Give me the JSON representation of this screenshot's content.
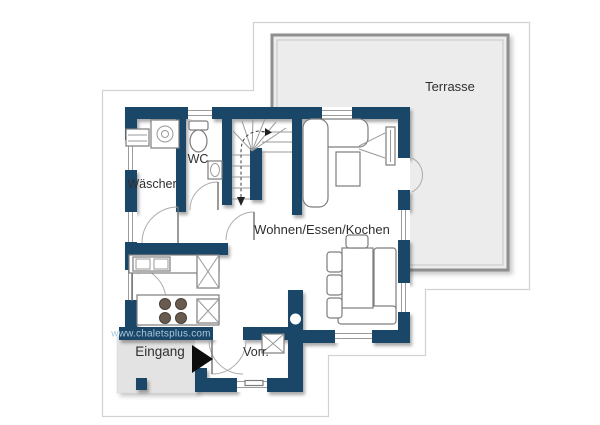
{
  "plan": {
    "rooms": {
      "terrasse": "Terrasse",
      "wc": "WC",
      "waescher": "Wäscher",
      "wohnen": "Wohnen/Essen/Kochen",
      "eingang": "Eingang",
      "vorr": "Vorr."
    },
    "watermark": "www.chaletsplus.com",
    "colors": {
      "wall": "#1a4768",
      "terrace_fill": "#ececec",
      "terrace_border": "#8f8f8f",
      "porch_fill": "#e3e3e3",
      "watermark_text": "#a9c7df",
      "label_text": "#2f2f2f",
      "outline": "#d2d2d2"
    }
  }
}
